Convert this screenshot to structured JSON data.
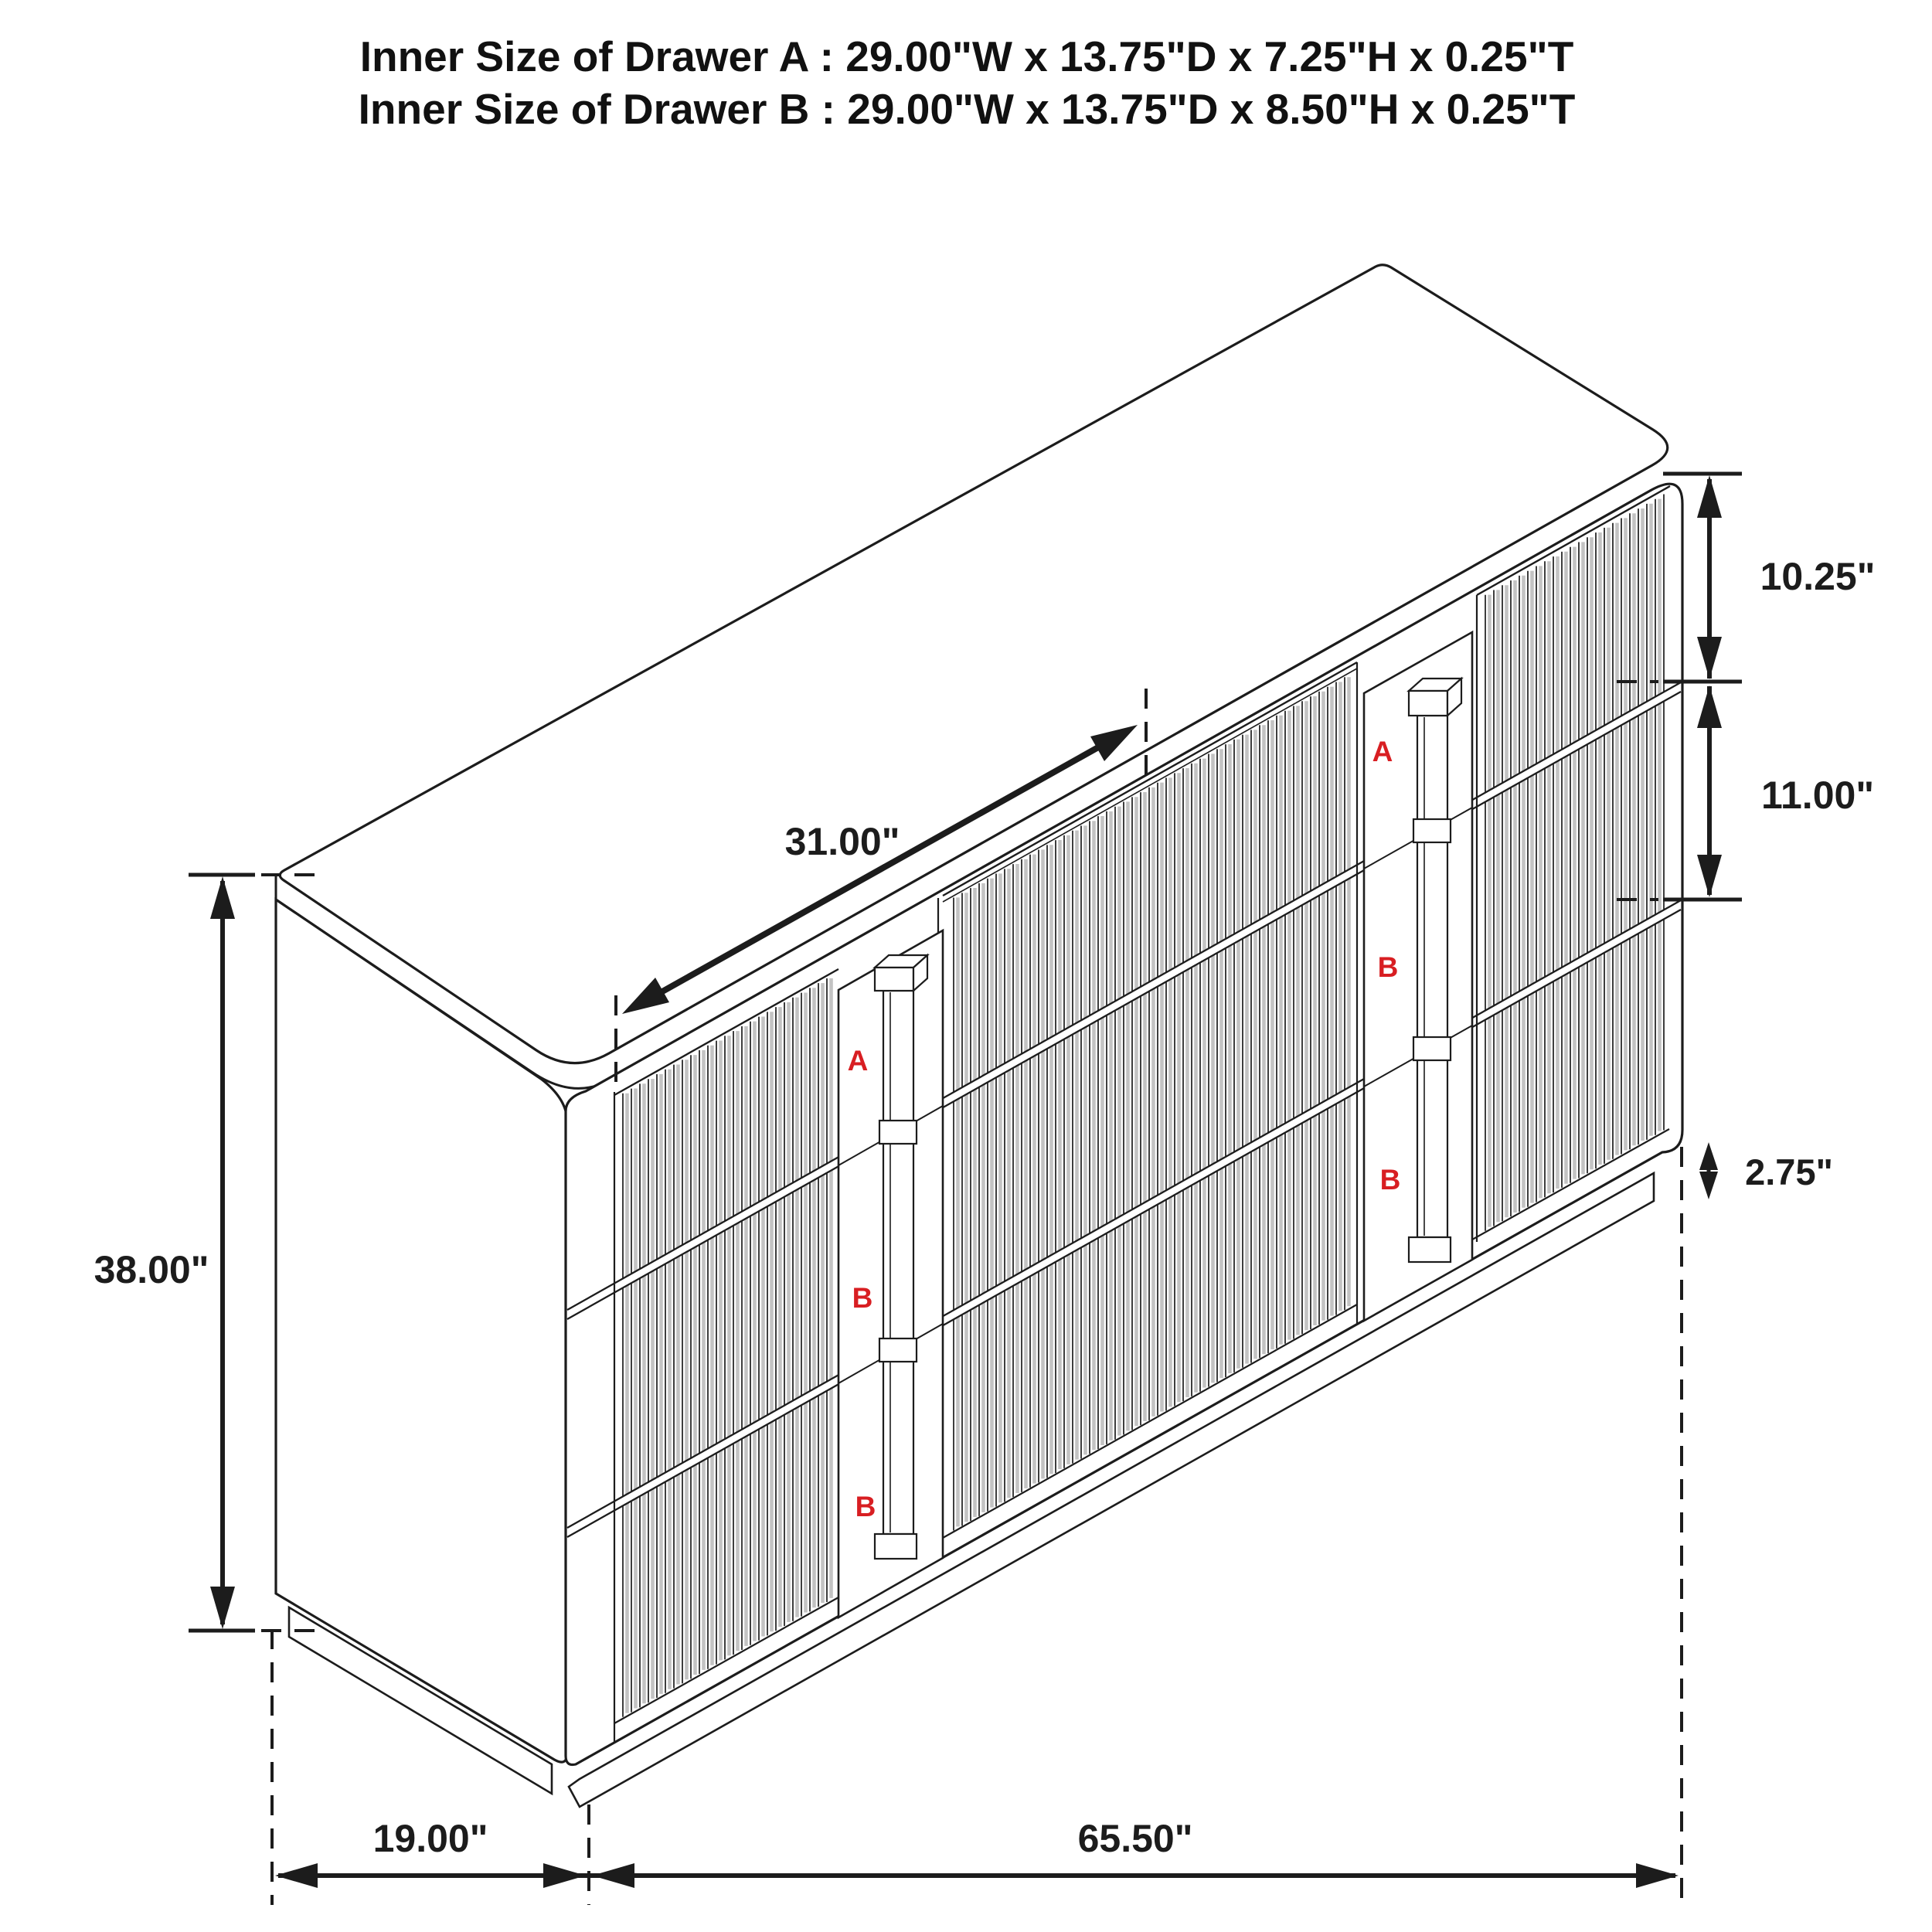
{
  "title": {
    "line1": "Inner Size of Drawer A : 29.00\"W x 13.75\"D x 7.25\"H x 0.25\"T",
    "line2": "Inner Size of Drawer B : 29.00\"W x 13.75\"D x 8.50\"H x 0.25\"T"
  },
  "dimensions": {
    "overall_height": "38.00\"",
    "depth": "19.00\"",
    "overall_width": "65.50\"",
    "center_drawer_width": "31.00\"",
    "top_drawer_height": "10.25\"",
    "middle_drawer_height": "11.00\"",
    "base_height": "2.75\""
  },
  "drawer_labels": {
    "left_stack": [
      "A",
      "B",
      "B"
    ],
    "right_stack": [
      "A",
      "B",
      "B"
    ]
  },
  "colors": {
    "line": "#1c1c1c",
    "red_label": "#d81e22",
    "flute_shade": "#c3c3c3",
    "background": "#ffffff"
  }
}
